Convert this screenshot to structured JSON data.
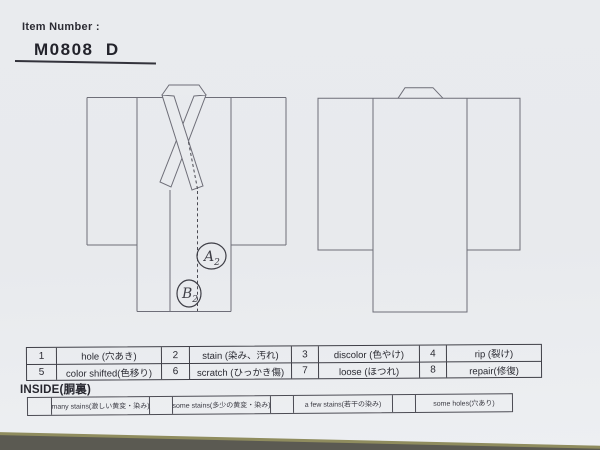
{
  "colors": {
    "paper": "#e9ebee",
    "desk_background": "#5b5a52",
    "paper_edge": "#8f8c5e",
    "diagram_line": "#6e6e78",
    "table_border": "#3f3f47",
    "ink": "#2a2a32"
  },
  "header": {
    "label": "Item Number :",
    "item_number": "M0808  D"
  },
  "diagram": {
    "front_view_name": "kimono-front-outline",
    "back_view_name": "kimono-back-outline",
    "annotations": [
      {
        "letter": "A",
        "sub": "2"
      },
      {
        "letter": "B",
        "sub": "2"
      }
    ]
  },
  "condition_table": {
    "rows": [
      [
        {
          "num": "1",
          "label": "hole (穴あき)"
        },
        {
          "num": "2",
          "label": "stain (染み、汚れ)"
        },
        {
          "num": "3",
          "label": "discolor (色やけ)"
        },
        {
          "num": "4",
          "label": "rip (裂け)"
        }
      ],
      [
        {
          "num": "5",
          "label": "color shifted(色移り)"
        },
        {
          "num": "6",
          "label": "scratch (ひっかき傷)"
        },
        {
          "num": "7",
          "label": "loose (ほつれ)"
        },
        {
          "num": "8",
          "label": "repair(修復)"
        }
      ]
    ]
  },
  "inside_section": {
    "label": "INSIDE(胴裏)",
    "options": [
      {
        "label": "many stains(激しい黄変・染み)"
      },
      {
        "label": "some stains(多少の黄変・染み)"
      },
      {
        "label": "a few stains(若干の染み)"
      },
      {
        "label": "some holes(穴あり)"
      }
    ]
  }
}
